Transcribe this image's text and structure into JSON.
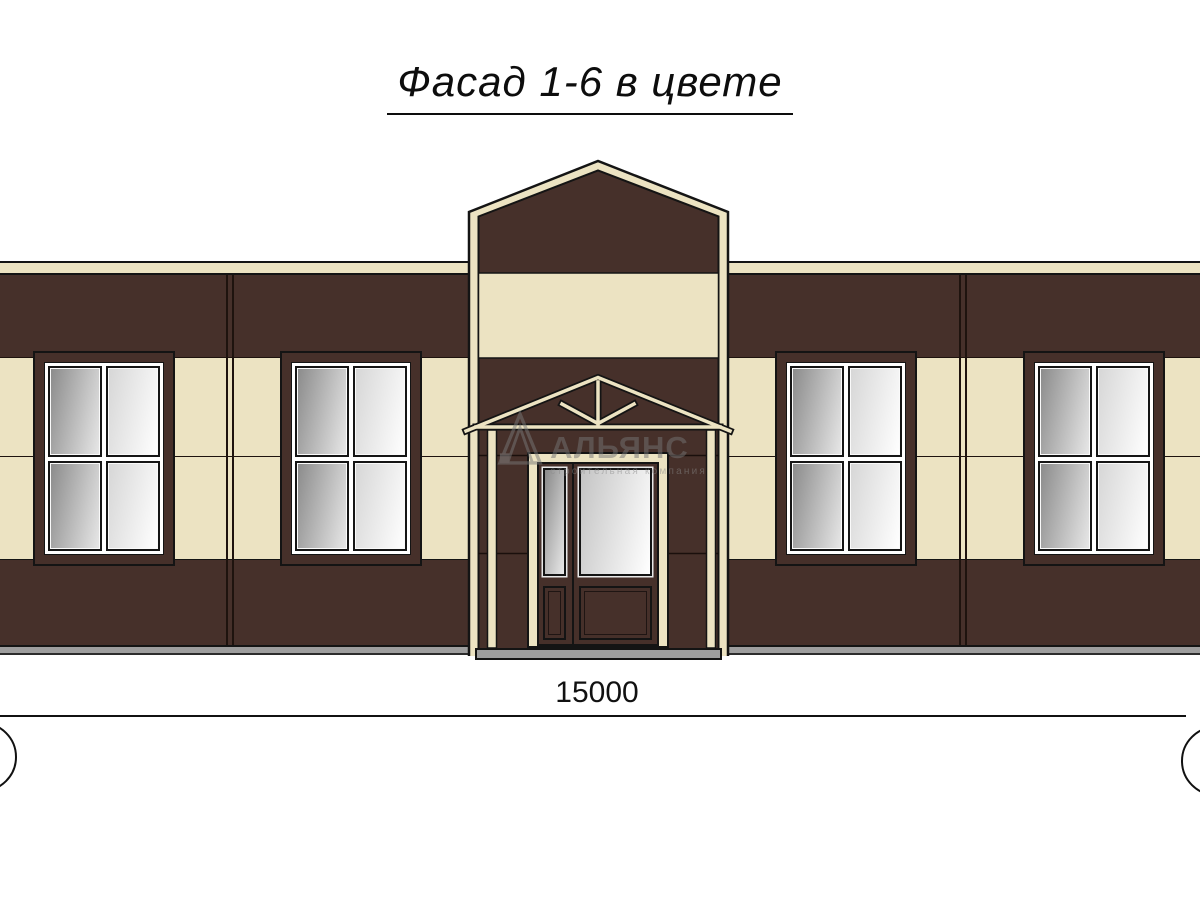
{
  "title": "Фасад 1-6 в цвете",
  "dimension": {
    "value": "15000"
  },
  "watermark": {
    "brand": "АЛЬЯНС",
    "tagline": "строительная компания"
  },
  "colors": {
    "wall-brown": "#46302a",
    "wall-cream": "#ece3c2",
    "outline": "#141414",
    "joint": "#1e130e",
    "plinth-gray": "#9e9e9e",
    "glass-dark-a": "#8a8a8a",
    "glass-dark-b": "#e8e8e8",
    "glass-light-a": "#d6d6d6",
    "glass-light-b": "#ffffff",
    "wm-gray": "#757575"
  },
  "facade": {
    "windows_count": 4,
    "window_panes_per_window": 4,
    "bands": [
      "cream cornice",
      "dark brown",
      "cream",
      "cream",
      "dark brown",
      "gray plinth"
    ],
    "entrance": "central gabled tower with king-post portico and double glazed door"
  }
}
